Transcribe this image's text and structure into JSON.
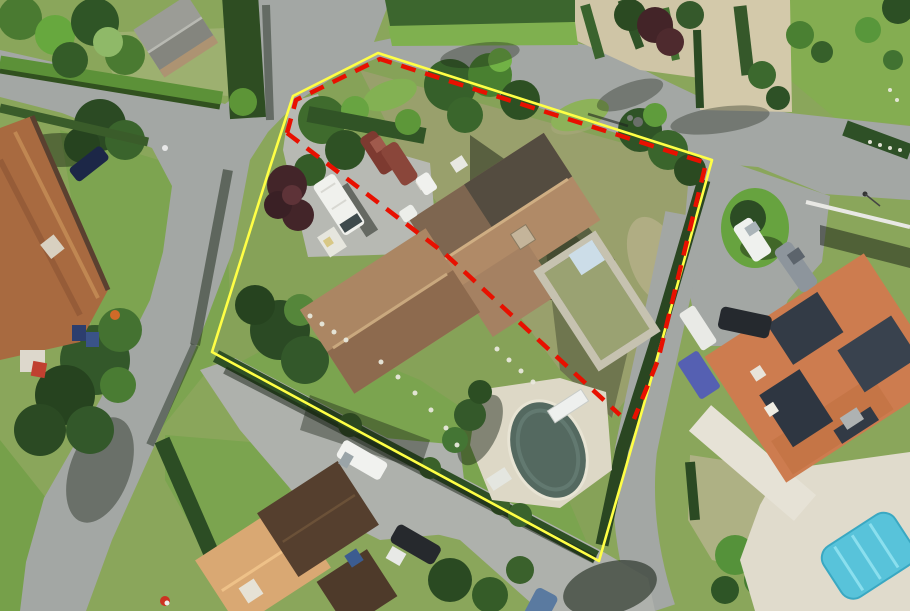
{
  "scene": {
    "type": "aerial-photograph",
    "description": "Aerial view of a residential parcel with a house, caravan, garden and oval pool, outlined by a yellow cadastral boundary; a red dashed line marks a sub-area along the north-east boundary and diagonally through the house"
  },
  "palette": {
    "grass_base": "#8aa65b",
    "road": "#a3a7a4",
    "road_light": "#aeb1ac",
    "walkway_beige": "#cfc5a6",
    "garden_olive": "#99a06c",
    "lawn_bright": "#7ba44f",
    "hedge_dark": "#2e4d23",
    "foliage_bright": "#6fae3f",
    "roof_tan": "#b08a67",
    "roof_rust": "#a86a40",
    "roof_dark_brown": "#553f2e",
    "roof_orange": "#cd7c4f",
    "solar_panel": "#333b46",
    "pool_dark": "#546960",
    "pool_cyan": "#58c3da",
    "deck_white": "#ddd8c6",
    "vehicle_white": "#f0f1ed",
    "shadow": "rgba(22,30,18,0.45)"
  },
  "overlays": {
    "parcel_boundary": {
      "color": "#ffff45",
      "stroke_width": "2.6",
      "points": "378,53 712,160 656,362 599,561 212,352 270,167 293,96"
    },
    "red_dashed_boundary": {
      "color": "#e81000",
      "stroke_width": "4.5",
      "dash": "15 10",
      "points": "287,133 296,100 380,59 706,163 658,360 634,419"
    },
    "red_dashed_diagonal": {
      "color": "#e81000",
      "stroke_width": "4.5",
      "dash": "15 10",
      "points": "287,133 443,252 620,415"
    }
  }
}
